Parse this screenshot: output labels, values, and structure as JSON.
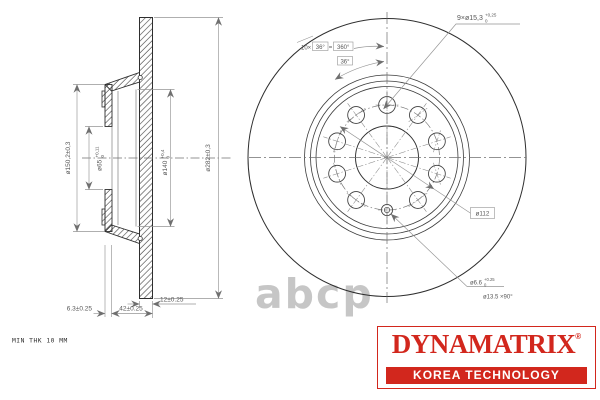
{
  "sec": {
    "d282": "ø282±0,3",
    "d150": "ø150,2±0,3",
    "d65": "ø65",
    "d65sup": "+0,11",
    "d65sub": "0",
    "d140": "ø140",
    "d140sup": "+0,4",
    "d140sub": "0",
    "d12": "12±0.25",
    "d42": "42±0.25",
    "d63": "6.3±0.25",
    "note": "MIN THK 10 MM"
  },
  "front": {
    "holes": "9×ø15,3",
    "holesSup": "+0,25",
    "holesSub": "0",
    "spacingPrefix": "10×",
    "spacingAngle": "36°",
    "eq": "=",
    "spacingTotal": "360°",
    "angle": "36°",
    "bcd": "ø112",
    "pin": "ø6.6",
    "pinSup": "+0.25",
    "pinSub": "0",
    "csk": "ø13.5 ×90°"
  },
  "watermark": "abcp",
  "logo": {
    "brand": "DYNAMATRIX",
    "registered": "®",
    "tagline": "KOREA TECHNOLOGY",
    "red": "#d2271d"
  }
}
